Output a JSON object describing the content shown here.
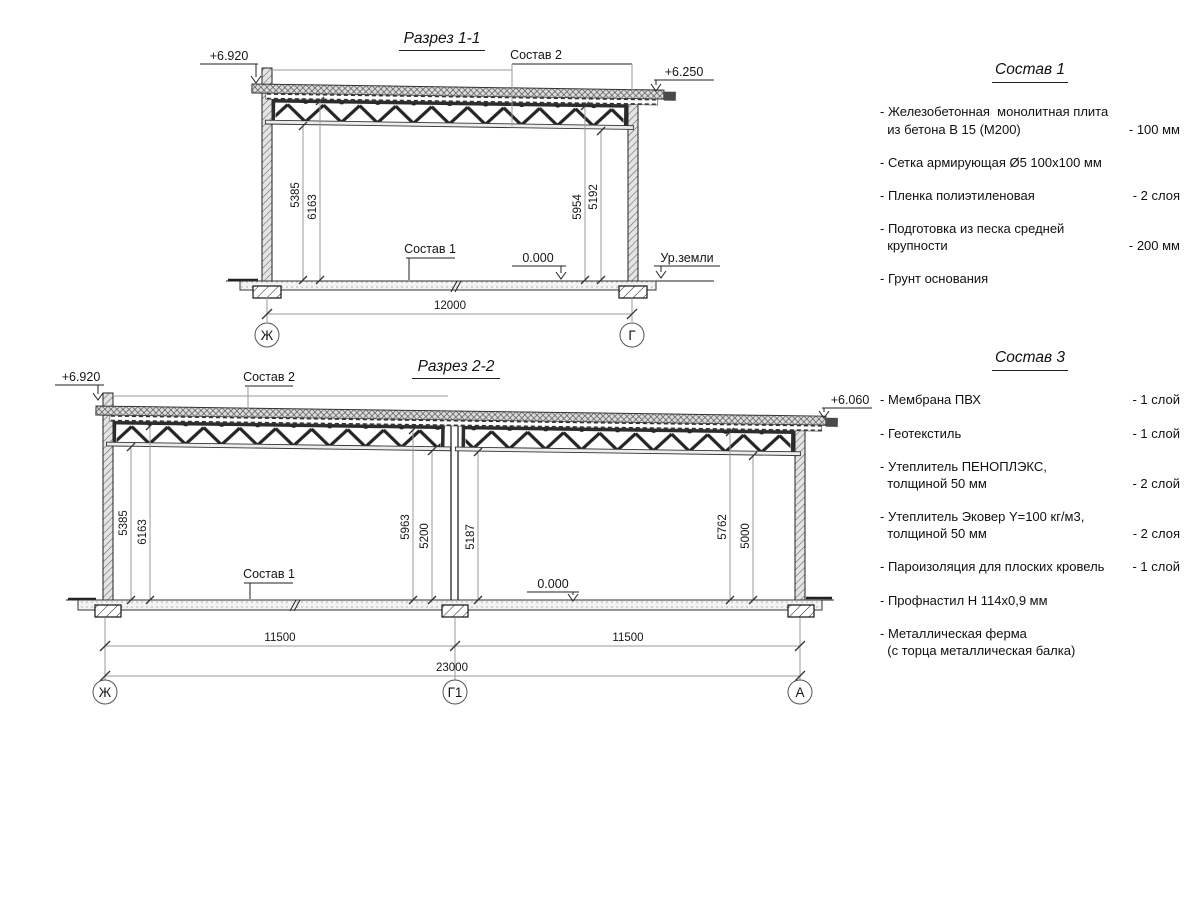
{
  "section1": {
    "title": "Разрез 1-1",
    "elev_left": "+6.920",
    "elev_right": "+6.250",
    "roof_layer_label": "Состав 2",
    "floor_layer_label": "Состав 1",
    "zero_level": "0.000",
    "ground_level_label": "Ур.земли",
    "span": "12000",
    "vdims": [
      "5385",
      "6163",
      "5954",
      "5192"
    ],
    "axes": [
      "Ж",
      "Г"
    ]
  },
  "section2": {
    "title": "Разрез 2-2",
    "elev_left": "+6.920",
    "elev_right": "+6.060",
    "roof_layer_label": "Состав 2",
    "floor_layer_label": "Состав 1",
    "zero_level": "0.000",
    "spans": [
      "11500",
      "11500"
    ],
    "total": "23000",
    "vdims": [
      "5385",
      "6163",
      "5963",
      "5200",
      "5187",
      "5762",
      "5000"
    ],
    "axes": [
      "Ж",
      "Г1",
      "А"
    ]
  },
  "panel1": {
    "title": "Состав 1",
    "items": [
      {
        "name": "- Железобетонная  монолитная плита\n  из бетона В 15 (М200)",
        "value": "- 100 мм"
      },
      {
        "name": "- Сетка армирующая Ø5 100x100 мм",
        "value": ""
      },
      {
        "name": "- Пленка полиэтиленовая",
        "value": "-  2 слоя"
      },
      {
        "name": "- Подготовка из песка средней\n  крупности",
        "value": "- 200 мм"
      },
      {
        "name": "- Грунт основания",
        "value": ""
      }
    ]
  },
  "panel3": {
    "title": "Состав 3",
    "items": [
      {
        "name": "- Мембрана ПВХ",
        "value": "- 1 слой"
      },
      {
        "name": "- Геотекстиль",
        "value": "- 1 слой"
      },
      {
        "name": "- Утеплитель ПЕНОПЛЭКС,\n  толщиной 50 мм",
        "value": "- 2 слой"
      },
      {
        "name": "- Утеплитель Эковер Y=100 кг/м3,\n  толщиной 50 мм",
        "value": "- 2 слоя"
      },
      {
        "name": "- Пароизоляция для плоских кровель",
        "value": "- 1 слой"
      },
      {
        "name": "- Профнастил Н 114х0,9 мм",
        "value": ""
      },
      {
        "name": "- Металлическая ферма\n  (с торца металлическая балка)",
        "value": ""
      }
    ]
  }
}
